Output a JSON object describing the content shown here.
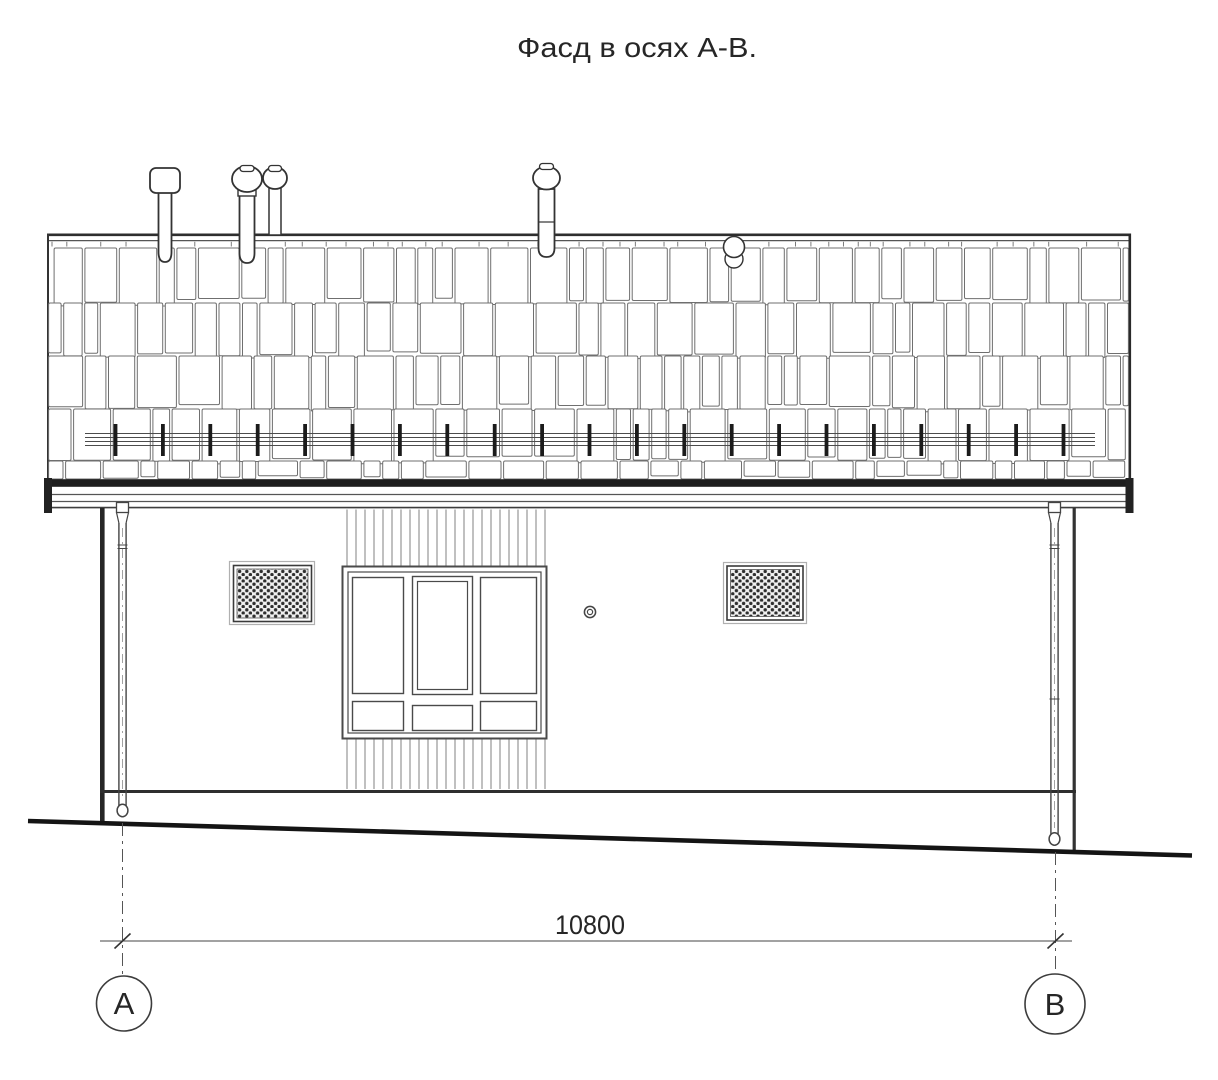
{
  "title": "Фасд в осях А-В.",
  "dimension": {
    "label": "10800"
  },
  "axes": {
    "left": "А",
    "right": "В"
  },
  "colors": {
    "ink": "#2b2b2b",
    "line_medium": "#555555",
    "line_light": "#8c8c8c",
    "paper": "#ffffff"
  }
}
